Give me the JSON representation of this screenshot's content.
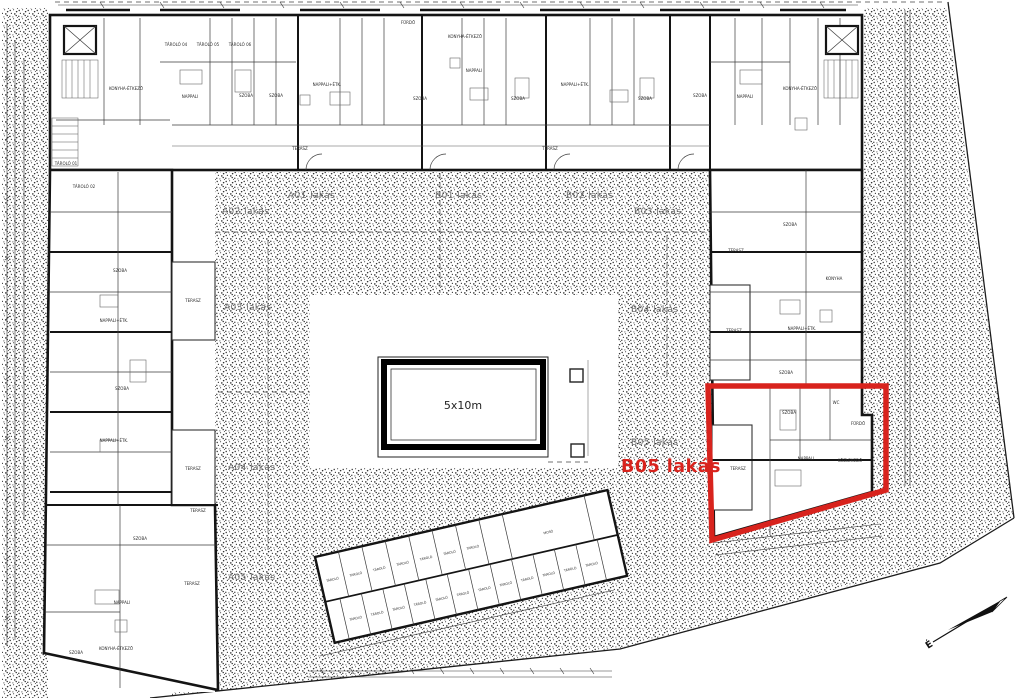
{
  "colors": {
    "highlight": "#d8231d",
    "ink": "#141414",
    "label_gray": "#6e6e6e"
  },
  "pool": {
    "label": "5x10m"
  },
  "highlight": {
    "label": "B05 lakás"
  },
  "north": {
    "label": "É"
  },
  "zone_labels": [
    {
      "text": "A01 lakás",
      "x": 288,
      "y": 198
    },
    {
      "text": "B01 lakás",
      "x": 435,
      "y": 198
    },
    {
      "text": "B02 lakás",
      "x": 566,
      "y": 198
    },
    {
      "text": "A02 lakás",
      "x": 222,
      "y": 214
    },
    {
      "text": "B03 lakás",
      "x": 634,
      "y": 214
    },
    {
      "text": "A03 lakás",
      "x": 224,
      "y": 310
    },
    {
      "text": "B04 lakás",
      "x": 631,
      "y": 312
    },
    {
      "text": "A04 lakás",
      "x": 228,
      "y": 470
    },
    {
      "text": "B05 lakás",
      "x": 631,
      "y": 445
    },
    {
      "text": "A05 lakás",
      "x": 228,
      "y": 580
    }
  ],
  "room_labels": [
    {
      "text": "TÁROLÓ 04",
      "x": 176,
      "y": 46,
      "s": 3.4
    },
    {
      "text": "TÁROLÓ 05",
      "x": 208,
      "y": 46,
      "s": 3.4
    },
    {
      "text": "TÁROLÓ 06",
      "x": 240,
      "y": 46,
      "s": 3.4
    },
    {
      "text": "KONYHA-ÉTKEZŐ",
      "x": 126,
      "y": 90,
      "s": 3.4
    },
    {
      "text": "NAPPALI",
      "x": 190,
      "y": 98
    },
    {
      "text": "SZOBA",
      "x": 246,
      "y": 97
    },
    {
      "text": "SZOBA",
      "x": 276,
      "y": 97
    },
    {
      "text": "NAPPALI+ÉTK.",
      "x": 327,
      "y": 86
    },
    {
      "text": "FÜRDŐ",
      "x": 408,
      "y": 24,
      "s": 3.4
    },
    {
      "text": "SZOBA",
      "x": 420,
      "y": 100
    },
    {
      "text": "KONYHA-ÉTKEZŐ",
      "x": 465,
      "y": 38,
      "s": 3.4
    },
    {
      "text": "NAPPALI",
      "x": 474,
      "y": 72
    },
    {
      "text": "SZOBA",
      "x": 518,
      "y": 100
    },
    {
      "text": "NAPPALI+ÉTK.",
      "x": 575,
      "y": 86
    },
    {
      "text": "SZOBA",
      "x": 645,
      "y": 100
    },
    {
      "text": "SZOBA",
      "x": 700,
      "y": 97
    },
    {
      "text": "NAPPALI",
      "x": 745,
      "y": 98
    },
    {
      "text": "KONYHA-ÉTKEZŐ",
      "x": 800,
      "y": 90,
      "s": 3.4
    },
    {
      "text": "TERASZ",
      "x": 300,
      "y": 150,
      "s": 3.4
    },
    {
      "text": "TERASZ",
      "x": 550,
      "y": 150,
      "s": 3.4
    },
    {
      "text": "TÁROLÓ 01",
      "x": 66,
      "y": 165,
      "s": 3.2
    },
    {
      "text": "TÁROLÓ 02",
      "x": 84,
      "y": 188,
      "s": 3.2
    },
    {
      "text": "SZOBA",
      "x": 120,
      "y": 272
    },
    {
      "text": "NAPPALI+ÉTK.",
      "x": 114,
      "y": 322,
      "s": 3.6
    },
    {
      "text": "TERASZ",
      "x": 193,
      "y": 302,
      "s": 3.2
    },
    {
      "text": "SZOBA",
      "x": 122,
      "y": 390
    },
    {
      "text": "NAPPALI+ÉTK.",
      "x": 114,
      "y": 442,
      "s": 3.6
    },
    {
      "text": "TERASZ",
      "x": 193,
      "y": 470,
      "s": 3.2
    },
    {
      "text": "SZOBA",
      "x": 140,
      "y": 540
    },
    {
      "text": "TERASZ",
      "x": 198,
      "y": 512,
      "s": 3.2
    },
    {
      "text": "NAPPALI",
      "x": 122,
      "y": 604
    },
    {
      "text": "KONYHA-ÉTKEZŐ",
      "x": 116,
      "y": 650,
      "s": 3.2
    },
    {
      "text": "SZOBA",
      "x": 76,
      "y": 654
    },
    {
      "text": "TERASZ",
      "x": 192,
      "y": 585,
      "s": 3.2
    },
    {
      "text": "SZOBA",
      "x": 790,
      "y": 226
    },
    {
      "text": "TERASZ",
      "x": 736,
      "y": 252,
      "s": 3.4
    },
    {
      "text": "KONYHA",
      "x": 834,
      "y": 280,
      "s": 3.4
    },
    {
      "text": "NAPPALI+ÉTK.",
      "x": 802,
      "y": 330,
      "s": 3.6
    },
    {
      "text": "TERASZ",
      "x": 734,
      "y": 332,
      "s": 3.4
    },
    {
      "text": "SZOBA",
      "x": 786,
      "y": 374
    },
    {
      "text": "SZOBA",
      "x": 789,
      "y": 414
    },
    {
      "text": "WC",
      "x": 836,
      "y": 404,
      "s": 3
    },
    {
      "text": "FÜRDŐ",
      "x": 858,
      "y": 425,
      "s": 3
    },
    {
      "text": "NAPPALI",
      "x": 806,
      "y": 460
    },
    {
      "text": "KÖZLEKEDŐ",
      "x": 850,
      "y": 462,
      "s": 3
    },
    {
      "text": "TERASZ",
      "x": 738,
      "y": 470,
      "s": 3.4
    }
  ],
  "storage_labels": [
    {
      "text": "TÁROLÓ",
      "x": 327,
      "y": 584
    },
    {
      "text": "TÁROLÓ",
      "x": 351,
      "y": 584
    },
    {
      "text": "TÁROLÓ",
      "x": 375,
      "y": 584
    },
    {
      "text": "TÁROLÓ",
      "x": 399,
      "y": 584
    },
    {
      "text": "TÁROLÓ",
      "x": 423,
      "y": 584
    },
    {
      "text": "TÁROLÓ",
      "x": 447,
      "y": 584
    },
    {
      "text": "TÁROLÓ",
      "x": 471,
      "y": 584
    },
    {
      "text": "MOSÓ",
      "x": 548,
      "y": 586,
      "s": 4.4
    },
    {
      "text": "TÁROLÓ",
      "x": 341,
      "y": 627
    },
    {
      "text": "TÁROLÓ",
      "x": 363,
      "y": 627
    },
    {
      "text": "TÁROLÓ",
      "x": 385,
      "y": 627
    },
    {
      "text": "TÁROLÓ",
      "x": 407,
      "y": 627
    },
    {
      "text": "TÁROLÓ",
      "x": 429,
      "y": 627
    },
    {
      "text": "TÁROLÓ",
      "x": 451,
      "y": 627
    },
    {
      "text": "TÁROLÓ",
      "x": 473,
      "y": 627
    },
    {
      "text": "TÁROLÓ",
      "x": 495,
      "y": 627
    },
    {
      "text": "TÁROLÓ",
      "x": 517,
      "y": 627
    },
    {
      "text": "TÁROLÓ",
      "x": 539,
      "y": 627
    },
    {
      "text": "TÁROLÓ",
      "x": 561,
      "y": 627
    },
    {
      "text": "TÁROLÓ",
      "x": 583,
      "y": 627
    }
  ]
}
